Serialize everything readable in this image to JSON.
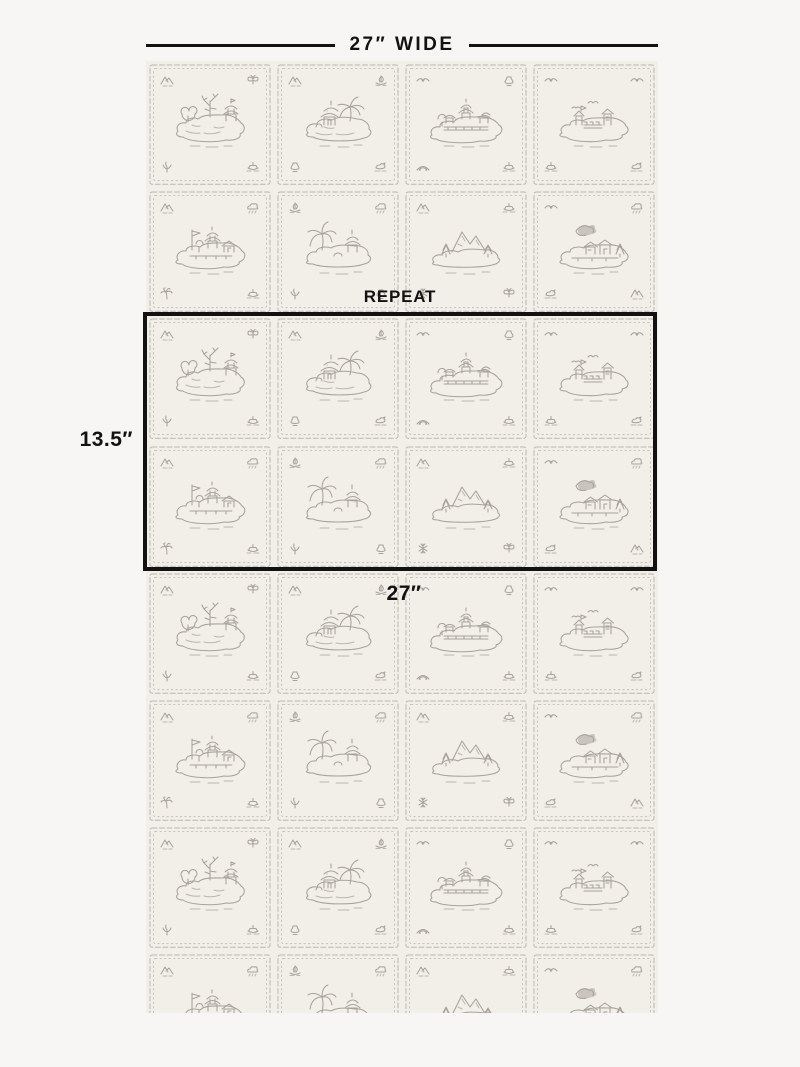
{
  "annotations": {
    "width_label": "27″ WIDE",
    "repeat_label": "REPEAT",
    "repeat_height_label": "13.5″",
    "repeat_width_label": "27″"
  },
  "colors": {
    "page_bg": "#f7f6f4",
    "swatch_bg": "#f2efe9",
    "ink": "#a7a399",
    "ink_light": "#bab7af",
    "annotation": "#121212"
  },
  "swatch": {
    "columns": 4,
    "visible_rows": 8,
    "repeat_rows": 2,
    "row_sequences": [
      [
        "tile-1",
        "tile-2",
        "tile-3",
        "tile-4"
      ],
      [
        "tile-5",
        "tile-6",
        "tile-7",
        "tile-8"
      ]
    ],
    "tiles": {
      "tile-1": {
        "name": "island-bare-tree-pagoda",
        "center": "c1",
        "corners": [
          "mountain",
          "butterfly",
          "plant",
          "boat"
        ]
      },
      "tile-2": {
        "name": "pagoda-with-willow",
        "center": "c2",
        "corners": [
          "mountain",
          "sailboat",
          "urn",
          "duck"
        ]
      },
      "tile-3": {
        "name": "grand-pagoda",
        "center": "c3",
        "corners": [
          "bird",
          "urn",
          "bridge",
          "boat"
        ]
      },
      "tile-4": {
        "name": "fortress-with-birds",
        "center": "c4",
        "corners": [
          "bird",
          "bird",
          "boat",
          "duck"
        ]
      },
      "tile-5": {
        "name": "pagoda-with-banner",
        "center": "c5",
        "corners": [
          "mountain",
          "cloud",
          "palm",
          "boat"
        ]
      },
      "tile-6": {
        "name": "weeping-tree-pagoda",
        "center": "c6",
        "corners": [
          "sailboat",
          "cloud",
          "plant",
          "urn"
        ]
      },
      "tile-7": {
        "name": "mountain-pines",
        "center": "c7",
        "corners": [
          "mountain",
          "boat",
          "snowflake",
          "butterfly"
        ]
      },
      "tile-8": {
        "name": "village-with-bird",
        "center": "c8",
        "corners": [
          "bird",
          "cloud",
          "duck",
          "mountain"
        ]
      }
    }
  }
}
